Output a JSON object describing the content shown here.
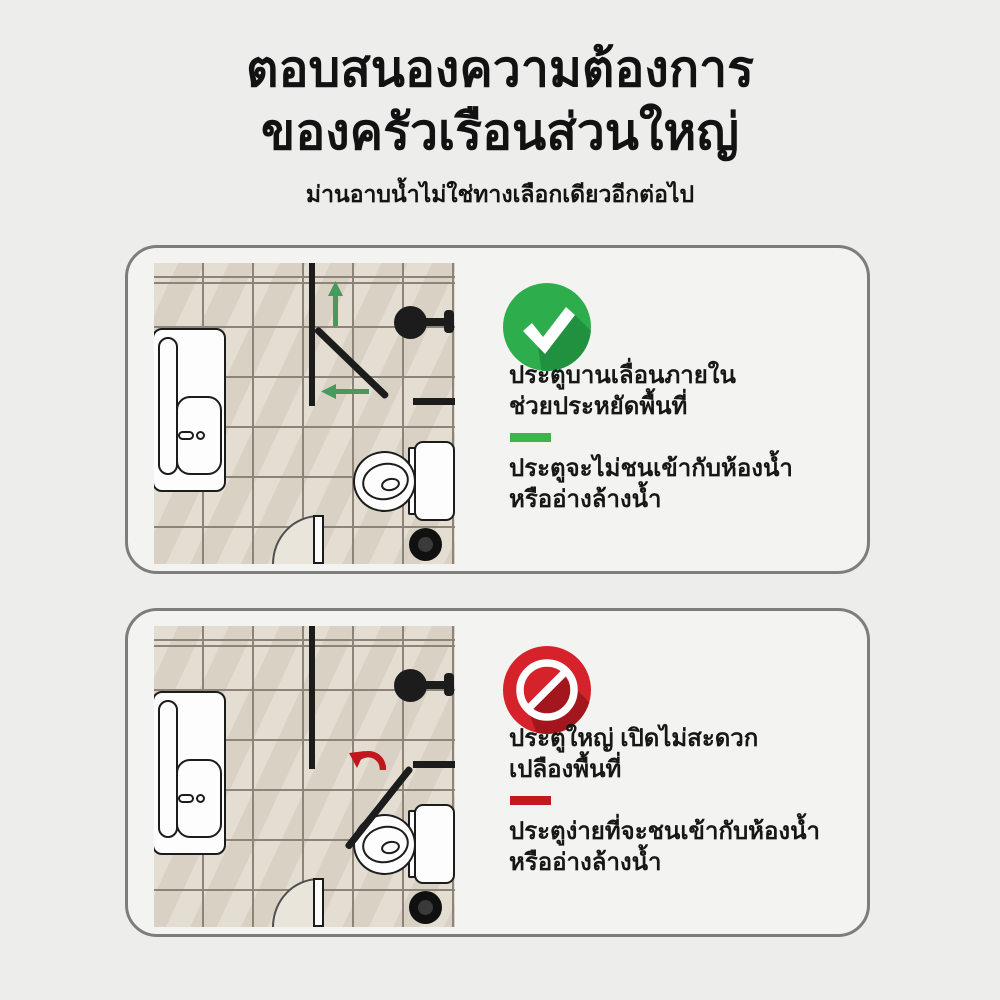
{
  "header": {
    "title_line1": "ตอบสนองความต้องการ",
    "title_line2": "ของครัวเรือนส่วนใหญ่",
    "subtitle": "ม่านอาบน้ำไม่ใช่ทางเลือกเดียวอีกต่อไป"
  },
  "cards": [
    {
      "id": "good-option",
      "icon": "check-circle-icon",
      "accent_color": "#2dad4c",
      "divider_color": "#3cb54a",
      "plan_arrow_icons": [
        "arrow-up-icon",
        "arrow-left-icon"
      ],
      "heading_lines": [
        "ประตูบานเลื่อนภายใน",
        "ช่วยประหยัดพื้นที่"
      ],
      "body_lines": [
        "ประตูจะไม่ชนเข้ากับห้องน้ำ",
        "หรืออ่างล้างน้ำ"
      ]
    },
    {
      "id": "bad-option",
      "icon": "no-entry-icon",
      "accent_color": "#d6232b",
      "divider_color": "#c2191f",
      "plan_arrow_icons": [
        "arrow-rotate-left-icon"
      ],
      "heading_lines": [
        "ประตูใหญ่ เปิดไม่สะดวก",
        "เปลืองพื้นที่"
      ],
      "body_lines": [
        "ประตูง่ายที่จะชนเข้ากับห้องน้ำ",
        "หรืออ่างล้างน้ำ"
      ]
    }
  ],
  "colors": {
    "page_background": "#ededec",
    "card_background": "#f3f3f2",
    "card_border": "#7d7d7d",
    "tile": "#ded7c9",
    "grout": "#8d8478",
    "fixture_line": "#1c1c1c",
    "text": "#161616"
  }
}
